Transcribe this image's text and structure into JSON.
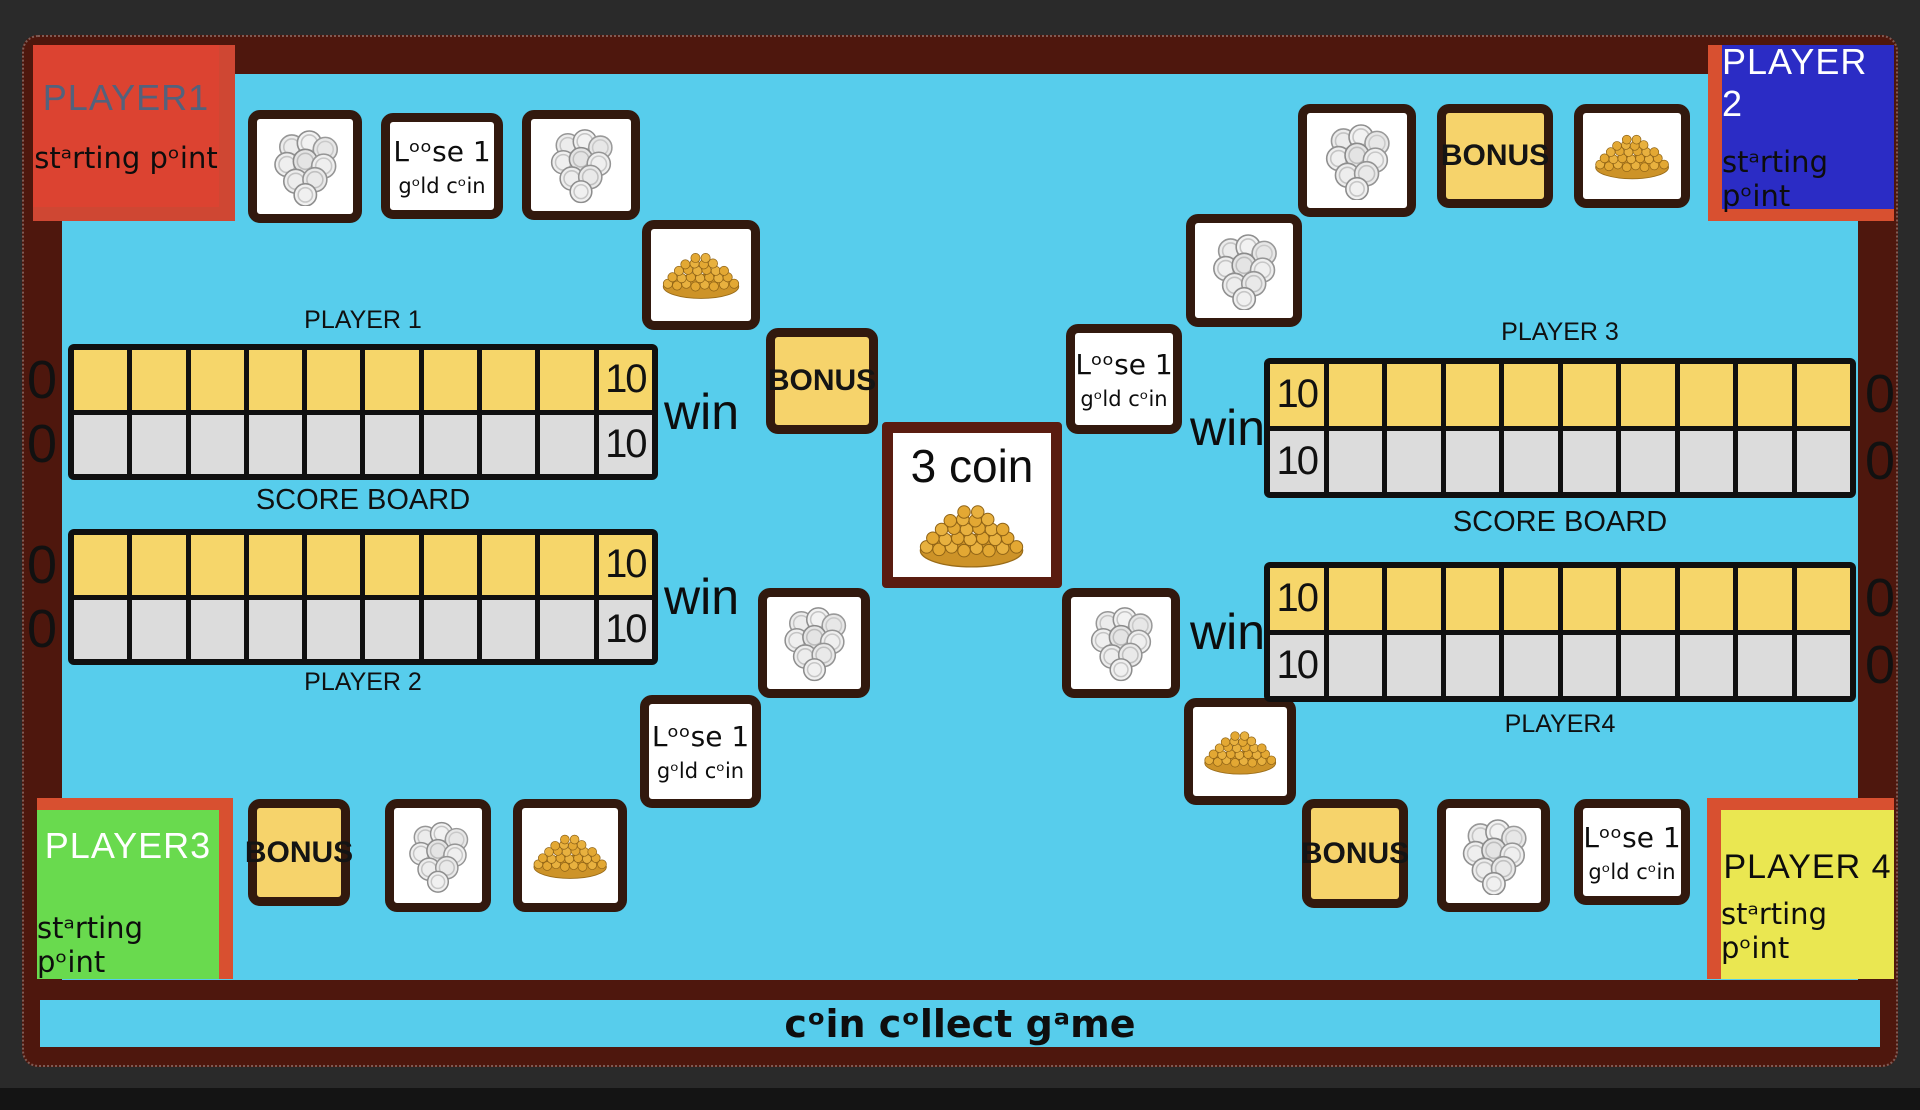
{
  "title": "cᵒin cᵒllect gᵃme",
  "corners": {
    "p1": {
      "title": "PLAYER1",
      "subtitle": "stᵃrting pᵒint"
    },
    "p2": {
      "title": "PLAYER 2",
      "subtitle": "stᵃrting pᵒint"
    },
    "p3": {
      "title": "PLAYER3",
      "subtitle": "stᵃrting pᵒint"
    },
    "p4": {
      "title": "PLAYER 4",
      "subtitle": "stᵃrting pᵒint"
    }
  },
  "tiles": {
    "bonus_label": "BONUS",
    "loose_title": "Lᵒᵒse 1",
    "loose_subtitle": "gᵒld cᵒin",
    "center_title": "3 coin",
    "silver_icon": "silver-coins",
    "gold_icon": "gold-coin-pile"
  },
  "scoreboard": {
    "cells_per_row": 10,
    "row_start": "0",
    "row_end": "10",
    "win_label": "win",
    "left": {
      "top": "PLAYER 1",
      "middle": "SCORE BOARD",
      "bottom": "PLAYER 2"
    },
    "right": {
      "top": "PLAYER 3",
      "middle": "SCORE BOARD",
      "bottom": "PLAYER4"
    }
  },
  "colors": {
    "board_blue": "#57cdec",
    "frame_maroon": "#4e170d",
    "cell_yellow": "#f6d66a",
    "cell_gray": "#dcdcdc",
    "bonus_yellow": "#f6d36b",
    "tile_border": "#32190e",
    "p1_red": "#dc4331",
    "p2_blue": "#2b2cc5",
    "p3_green": "#69da4e",
    "p4_yellow": "#eae751",
    "accent_orange": "#d85030"
  }
}
